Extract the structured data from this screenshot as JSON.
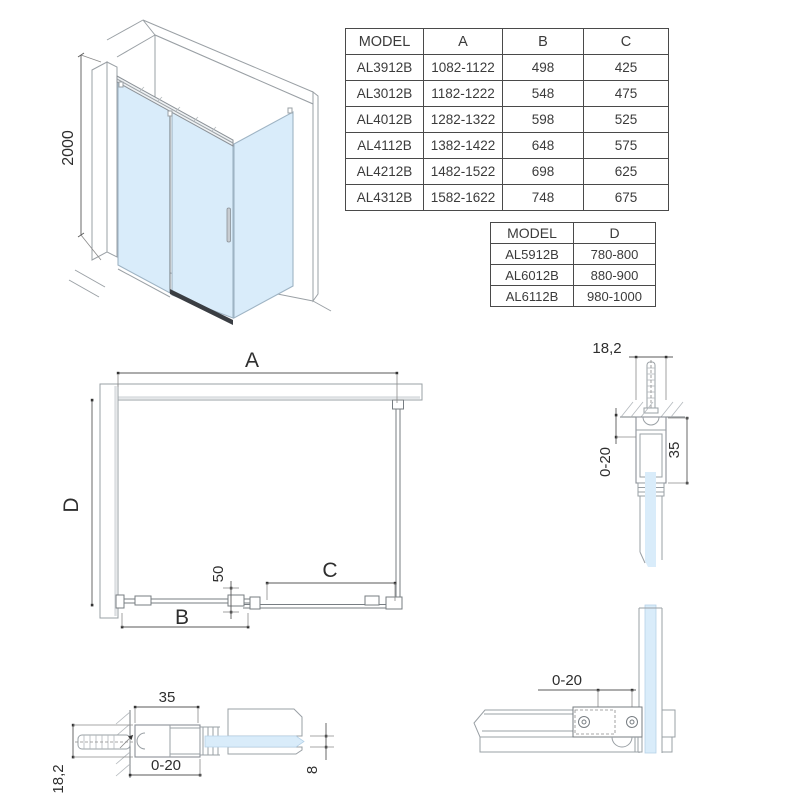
{
  "colors": {
    "glass": "#d9ecfa",
    "glass_edge": "#9fb4c4",
    "outline": "#9aa0a5",
    "rail_dark": "#3a3e43",
    "dimension": "#5a5a5a",
    "text": "#2e2e2e",
    "table_border": "#4a4a4a"
  },
  "iso_view": {
    "height_dim": "2000"
  },
  "tables": {
    "size_table": {
      "headers": [
        "MODEL",
        "A",
        "B",
        "C"
      ],
      "rows": [
        [
          "AL3912B",
          "1082-1122",
          "498",
          "425"
        ],
        [
          "AL3012B",
          "1182-1222",
          "548",
          "475"
        ],
        [
          "AL4012B",
          "1282-1322",
          "598",
          "525"
        ],
        [
          "AL4112B",
          "1382-1422",
          "648",
          "575"
        ],
        [
          "AL4212B",
          "1482-1522",
          "698",
          "625"
        ],
        [
          "AL4312B",
          "1582-1622",
          "748",
          "675"
        ]
      ]
    },
    "depth_table": {
      "headers": [
        "MODEL",
        "D"
      ],
      "rows": [
        [
          "AL5912B",
          "780-800"
        ],
        [
          "AL6012B",
          "880-900"
        ],
        [
          "AL6112B",
          "980-1000"
        ]
      ]
    }
  },
  "plan_view": {
    "dim_a": "A",
    "dim_b": "B",
    "dim_c": "C",
    "dim_d": "D",
    "dim_offset": "50"
  },
  "detail_wall_profile_vertical": {
    "dim_width": "18,2",
    "dim_adjust": "0-20",
    "dim_depth": "35"
  },
  "detail_wall_profile_horizontal": {
    "dim_depth": "35",
    "dim_adjust": "0-20",
    "dim_width": "18,2",
    "dim_glass": "8"
  },
  "detail_corner_connector": {
    "dim_adjust": "0-20"
  }
}
